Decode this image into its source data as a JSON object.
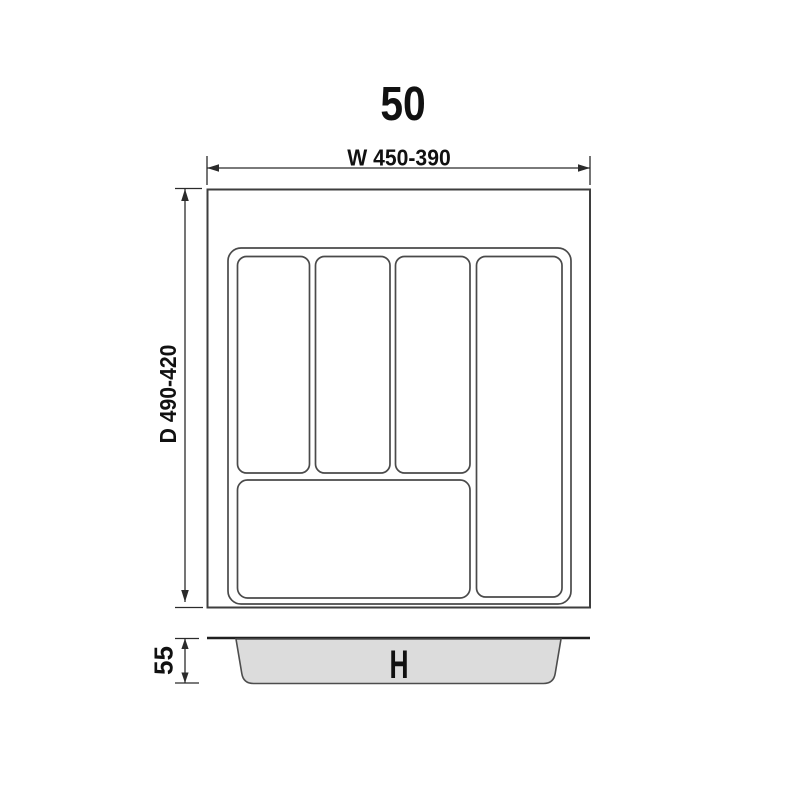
{
  "drawing": {
    "title": "50",
    "top_view": {
      "width_dimension": "W 450-390",
      "depth_dimension": "D 490-420"
    },
    "side_view": {
      "height_dimension": "55",
      "height_label": "H"
    }
  },
  "colors": {
    "background": "#ffffff",
    "outline": "#3e3e3e",
    "compartment_line": "#4a4a4a",
    "dimension_line": "#2b2b2b",
    "text": "#111111",
    "tray_fill": "#dcdcdc",
    "tray_stroke": "#4d4d4d",
    "side_top_line": "#1f1f1f"
  }
}
